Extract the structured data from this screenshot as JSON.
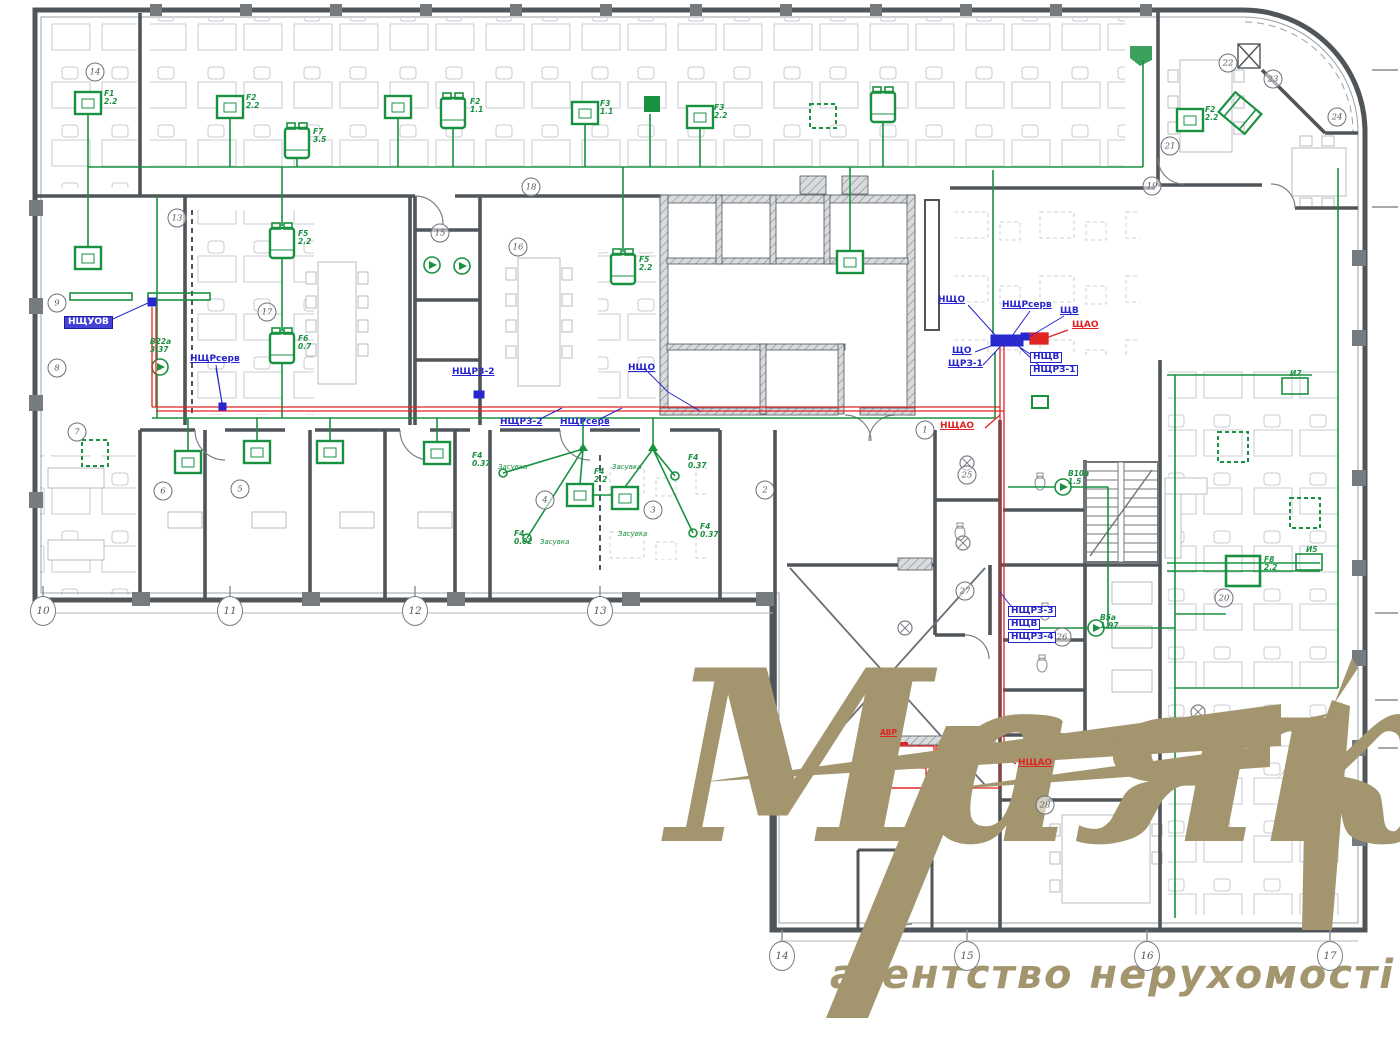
{
  "watermark": {
    "title": "Маяк",
    "subtitle": "агентство нерухомості"
  },
  "axis_bubbles": [
    {
      "n": "10"
    },
    {
      "n": "11"
    },
    {
      "n": "12"
    },
    {
      "n": "13"
    },
    {
      "n": "14"
    },
    {
      "n": "15"
    },
    {
      "n": "16"
    },
    {
      "n": "17"
    }
  ],
  "rooms": [
    {
      "n": "1"
    },
    {
      "n": "2"
    },
    {
      "n": "3"
    },
    {
      "n": "4"
    },
    {
      "n": "5"
    },
    {
      "n": "6"
    },
    {
      "n": "7"
    },
    {
      "n": "8"
    },
    {
      "n": "9"
    },
    {
      "n": "13"
    },
    {
      "n": "14"
    },
    {
      "n": "15"
    },
    {
      "n": "16"
    },
    {
      "n": "17"
    },
    {
      "n": "18"
    },
    {
      "n": "19"
    },
    {
      "n": "20"
    },
    {
      "n": "21"
    },
    {
      "n": "22"
    },
    {
      "n": "23"
    },
    {
      "n": "24"
    },
    {
      "n": "25"
    },
    {
      "n": "26"
    },
    {
      "n": "27"
    },
    {
      "n": "28"
    }
  ],
  "blue_labels": [
    {
      "t": "НЩУОВ"
    },
    {
      "t": "НЩРсерв"
    },
    {
      "t": "НЩРЗ-2"
    },
    {
      "t": "НЩРЗ-2"
    },
    {
      "t": "НЩРсерв"
    },
    {
      "t": "НЩО"
    },
    {
      "t": "НЩО"
    },
    {
      "t": "НЩРсерв"
    },
    {
      "t": "ЩВ"
    },
    {
      "t": "ЩО"
    },
    {
      "t": "ЩРЗ-1"
    },
    {
      "t": "НЩВ"
    },
    {
      "t": "НЩРЗ-1"
    },
    {
      "t": "НЩРЗ-3"
    },
    {
      "t": "НЩВ"
    },
    {
      "t": "НЩРЗ-4"
    }
  ],
  "red_labels": [
    {
      "t": "ЩАО"
    },
    {
      "t": "НЩАО"
    },
    {
      "t": "НЩАО"
    },
    {
      "t": "АВР"
    }
  ],
  "green_labels": [
    {
      "t": "F1\n2.2"
    },
    {
      "t": "F2\n2.2"
    },
    {
      "t": "F2\n1.1"
    },
    {
      "t": "F3\n1.1"
    },
    {
      "t": "F3\n2.2"
    },
    {
      "t": "F7\n3.5"
    },
    {
      "t": "F5\n2.2"
    },
    {
      "t": "F6\n0.7"
    },
    {
      "t": "F5\n2.2"
    },
    {
      "t": "F2\n2.2"
    },
    {
      "t": "F8\n2.2"
    },
    {
      "t": "F4\n2.2"
    },
    {
      "t": "F4\n0.37"
    },
    {
      "t": "F4\n0.02"
    },
    {
      "t": "F4\n0.37"
    },
    {
      "t": "F4\n0.37"
    },
    {
      "t": "В22а\n3.37"
    },
    {
      "t": "В10а\n1.5"
    },
    {
      "t": "В5а\n1.97"
    },
    {
      "t": "И7"
    },
    {
      "t": "И5"
    }
  ],
  "valve_labels": [
    {
      "t": "Засувка"
    },
    {
      "t": "Засувка"
    },
    {
      "t": "Засувка"
    },
    {
      "t": "Засувка"
    }
  ],
  "colors": {
    "wiring_green": "#1a9140",
    "panel_blue": "#2626cc",
    "emergency_red": "#e02424",
    "walls": "#50555a",
    "furniture": "#c7cbd0",
    "watermark": "#a3966f"
  }
}
